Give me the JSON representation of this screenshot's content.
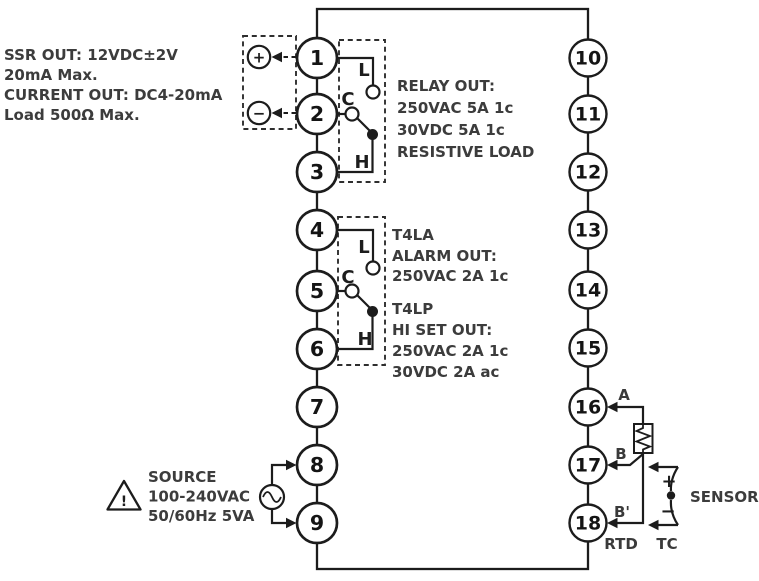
{
  "diagram": {
    "ssr_note": [
      "SSR OUT: 12VDC±2V",
      "20mA Max.",
      "CURRENT OUT: DC4-20mA",
      "Load 500Ω Max."
    ],
    "relay_note": [
      "RELAY OUT:",
      "250VAC 5A 1c",
      "30VDC 5A 1c",
      "RESISTIVE LOAD"
    ],
    "alarm_note": [
      "T4LA",
      "ALARM OUT:",
      "250VAC 2A 1c"
    ],
    "hiset_note": [
      "T4LP",
      "HI SET OUT:",
      "250VAC 2A 1c",
      "30VDC 2A ac"
    ],
    "source_note": [
      "SOURCE",
      "100-240VAC",
      "50/60Hz 5VA"
    ],
    "terminals_left": [
      "1",
      "2",
      "3",
      "4",
      "5",
      "6",
      "7",
      "8",
      "9"
    ],
    "terminals_right": [
      "10",
      "11",
      "12",
      "13",
      "14",
      "15",
      "16",
      "17",
      "18"
    ],
    "relay1_contacts": {
      "l": "L",
      "c": "C",
      "h": "H"
    },
    "relay2_contacts": {
      "l": "L",
      "c": "C",
      "h": "H"
    },
    "output_polarity": {
      "plus": "+",
      "minus": "−"
    },
    "warning_mark": "!",
    "sensor": {
      "a": "A",
      "b": "B",
      "b_prime": "B'",
      "rtd": "RTD",
      "tc": "TC",
      "tc_plus": "+",
      "tc_minus": "−",
      "label": "SENSOR"
    },
    "colors": {
      "line": "#1c1c1c",
      "text": "#3c3c3c",
      "background": "#ffffff"
    }
  }
}
